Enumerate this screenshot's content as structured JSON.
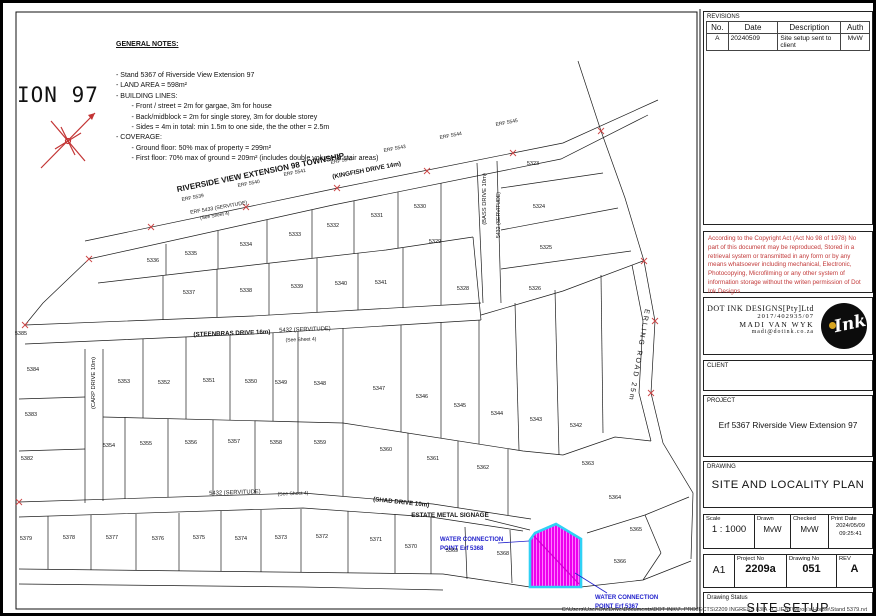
{
  "sheet": {
    "corner_text": "ION 97",
    "footer_path": "C:\\Users\\User\\OneDrive\\Documents\\DOT INK\\7. PROJECTS\\2209 INGRESS 83IA - CLIENT\\Miron's House\\Stand 5379.rvt"
  },
  "notes": {
    "title": "GENERAL NOTES:",
    "lines": [
      "- Stand 5367 of Riverside View Extension 97",
      "- LAND AREA = 598m²",
      "- BUILDING LINES:",
      "        - Front / street = 2m for gargae, 3m for house",
      "        - Back/midblock = 2m for single storey, 3m for double storey",
      "        - Sides = 4m in total: min 1.5m to one side, the the other = 2.5m",
      "- COVERAGE:",
      "        - Ground floor: 50% max of property = 299m²",
      "        - First floor: 70% max of ground = 209m² (includes double volume & stair areas)"
    ]
  },
  "map": {
    "highlight_erf": "5367",
    "highlight_fill": "#EE00EE",
    "highlight_border": "#2FD1F5",
    "labels": [
      {
        "t": "RIVERSIDE VIEW EXTENSION 98 TOWNSHIP",
        "x": 258,
        "y": 172,
        "r": -11.5,
        "s": 8,
        "b": 1,
        "n": "township-label"
      },
      {
        "t": "(KINGFISH DRIVE 14m)",
        "x": 364,
        "y": 169,
        "r": -11,
        "s": 6.3,
        "b": 1,
        "n": "road-label-kingfish"
      },
      {
        "t": "ERF 5433 (SERVITUDE)",
        "x": 216,
        "y": 206,
        "r": -10,
        "s": 5.2,
        "n": "servitude-label"
      },
      {
        "t": "(See Sheet 4)",
        "x": 212,
        "y": 214,
        "r": -10,
        "s": 4.8,
        "n": "see-sheet-label"
      },
      {
        "t": "ERF 5539",
        "x": 190,
        "y": 196,
        "r": -11,
        "s": 5,
        "n": "erf-label"
      },
      {
        "t": "ERF 5540",
        "x": 246,
        "y": 182,
        "r": -11,
        "s": 5,
        "n": "erf-label"
      },
      {
        "t": "ERF 5541",
        "x": 292,
        "y": 171,
        "r": -11,
        "s": 5,
        "n": "erf-label"
      },
      {
        "t": "ERF 5542",
        "x": 339,
        "y": 159,
        "r": -11,
        "s": 5,
        "n": "erf-label"
      },
      {
        "t": "ERF 5543",
        "x": 392,
        "y": 147,
        "r": -11,
        "s": 5,
        "n": "erf-label"
      },
      {
        "t": "ERF 5544",
        "x": 448,
        "y": 134,
        "r": -11,
        "s": 5,
        "n": "erf-label"
      },
      {
        "t": "ERF 5545",
        "x": 504,
        "y": 121,
        "r": -11,
        "s": 5,
        "n": "erf-label"
      },
      {
        "t": "(STEENBRAS DRIVE 16m)",
        "x": 229,
        "y": 332,
        "r": -2,
        "s": 6.2,
        "b": 1,
        "n": "road-label-steenbras"
      },
      {
        "t": "5432 (SERVITUDE)",
        "x": 302,
        "y": 328,
        "r": -2,
        "s": 5.8,
        "n": "servitude-label"
      },
      {
        "t": "(See Sheet 4)",
        "x": 298,
        "y": 338,
        "r": -2,
        "s": 5,
        "n": "see-sheet-label"
      },
      {
        "t": "(BASS DRIVE 10m)",
        "x": 483,
        "y": 196,
        "r": -90,
        "s": 5.8,
        "n": "road-label-bass"
      },
      {
        "t": "5432 (SERVITUDE)",
        "x": 497,
        "y": 212,
        "r": -90,
        "s": 5.2,
        "n": "servitude-label"
      },
      {
        "t": "ERLING ROAD 25m",
        "x": 634,
        "y": 352,
        "r": 100,
        "s": 7,
        "sp": 2,
        "n": "road-label-erling"
      },
      {
        "t": "(CARP DRIVE 10m)",
        "x": 92,
        "y": 380,
        "r": -90,
        "s": 5.8,
        "n": "road-label-carp"
      },
      {
        "t": "5432 (SERVITUDE)",
        "x": 232,
        "y": 491,
        "r": -2,
        "s": 5.8,
        "n": "servitude-label"
      },
      {
        "t": "(See Sheet 4)",
        "x": 290,
        "y": 492,
        "r": -2,
        "s": 5,
        "n": "see-sheet-label"
      },
      {
        "t": "(SHAD DRIVE 10m)",
        "x": 398,
        "y": 501,
        "r": 6,
        "s": 6.2,
        "b": 1,
        "n": "road-label-shad"
      },
      {
        "t": "ESTATE METAL SIGNAGE",
        "x": 447,
        "y": 514,
        "r": 0,
        "s": 6.3,
        "b": 1,
        "n": "signage-label"
      },
      {
        "t": "WATER CONNECTION",
        "x": 437,
        "y": 538,
        "r": 0,
        "s": 6,
        "b": 1,
        "c": "#2222CC",
        "a": "start",
        "n": "water-connection-label-5368"
      },
      {
        "t": "POINT Erf 5368",
        "x": 437,
        "y": 547,
        "r": 0,
        "s": 6,
        "b": 1,
        "c": "#2222CC",
        "a": "start",
        "n": "water-connection-label-5368"
      },
      {
        "t": "WATER CONNECTION",
        "x": 592,
        "y": 596,
        "r": 0,
        "s": 6,
        "b": 1,
        "c": "#2222CC",
        "a": "start",
        "n": "water-connection-label-5367"
      },
      {
        "t": "POINT Erf 5367",
        "x": 592,
        "y": 605,
        "r": 0,
        "s": 6,
        "b": 1,
        "c": "#2222CC",
        "a": "start",
        "n": "water-connection-label-5367"
      }
    ],
    "parcels": [
      {
        "id": "5336",
        "x": 150,
        "y": 259
      },
      {
        "id": "5335",
        "x": 188,
        "y": 252
      },
      {
        "id": "5334",
        "x": 243,
        "y": 243
      },
      {
        "id": "5333",
        "x": 292,
        "y": 233
      },
      {
        "id": "5332",
        "x": 330,
        "y": 224
      },
      {
        "id": "5331",
        "x": 374,
        "y": 214
      },
      {
        "id": "5330",
        "x": 417,
        "y": 205
      },
      {
        "id": "5337",
        "x": 186,
        "y": 291
      },
      {
        "id": "5338",
        "x": 243,
        "y": 289
      },
      {
        "id": "5339",
        "x": 294,
        "y": 285
      },
      {
        "id": "5340",
        "x": 338,
        "y": 282
      },
      {
        "id": "5341",
        "x": 378,
        "y": 281
      },
      {
        "id": "5329",
        "x": 432,
        "y": 240
      },
      {
        "id": "5328",
        "x": 460,
        "y": 287
      },
      {
        "id": "5323",
        "x": 530,
        "y": 162
      },
      {
        "id": "5324",
        "x": 536,
        "y": 205
      },
      {
        "id": "5325",
        "x": 543,
        "y": 246
      },
      {
        "id": "5326",
        "x": 532,
        "y": 287
      },
      {
        "id": "5385",
        "x": 18,
        "y": 332
      },
      {
        "id": "5384",
        "x": 30,
        "y": 368
      },
      {
        "id": "5383",
        "x": 28,
        "y": 413
      },
      {
        "id": "5382",
        "x": 24,
        "y": 457
      },
      {
        "id": "5353",
        "x": 121,
        "y": 380
      },
      {
        "id": "5352",
        "x": 161,
        "y": 381
      },
      {
        "id": "5351",
        "x": 206,
        "y": 379
      },
      {
        "id": "5350",
        "x": 248,
        "y": 380
      },
      {
        "id": "5349",
        "x": 278,
        "y": 381
      },
      {
        "id": "5348",
        "x": 317,
        "y": 382
      },
      {
        "id": "5347",
        "x": 376,
        "y": 387
      },
      {
        "id": "5346",
        "x": 419,
        "y": 395
      },
      {
        "id": "5345",
        "x": 457,
        "y": 404
      },
      {
        "id": "5344",
        "x": 494,
        "y": 412
      },
      {
        "id": "5343",
        "x": 533,
        "y": 418
      },
      {
        "id": "5342",
        "x": 573,
        "y": 424
      },
      {
        "id": "5354",
        "x": 106,
        "y": 444
      },
      {
        "id": "5355",
        "x": 143,
        "y": 442
      },
      {
        "id": "5356",
        "x": 188,
        "y": 441
      },
      {
        "id": "5357",
        "x": 231,
        "y": 440
      },
      {
        "id": "5358",
        "x": 273,
        "y": 441
      },
      {
        "id": "5359",
        "x": 317,
        "y": 441
      },
      {
        "id": "5360",
        "x": 383,
        "y": 448
      },
      {
        "id": "5361",
        "x": 430,
        "y": 457
      },
      {
        "id": "5362",
        "x": 480,
        "y": 466
      },
      {
        "id": "5363",
        "x": 585,
        "y": 462
      },
      {
        "id": "5379",
        "x": 23,
        "y": 537
      },
      {
        "id": "5378",
        "x": 66,
        "y": 536
      },
      {
        "id": "5377",
        "x": 109,
        "y": 536
      },
      {
        "id": "5376",
        "x": 155,
        "y": 537
      },
      {
        "id": "5375",
        "x": 196,
        "y": 536
      },
      {
        "id": "5374",
        "x": 238,
        "y": 537
      },
      {
        "id": "5373",
        "x": 278,
        "y": 536
      },
      {
        "id": "5372",
        "x": 319,
        "y": 535
      },
      {
        "id": "5371",
        "x": 373,
        "y": 538
      },
      {
        "id": "5370",
        "x": 408,
        "y": 545
      },
      {
        "id": "5369",
        "x": 449,
        "y": 549
      },
      {
        "id": "5368",
        "x": 500,
        "y": 552
      },
      {
        "id": "5366",
        "x": 617,
        "y": 560
      },
      {
        "id": "5365",
        "x": 633,
        "y": 528
      },
      {
        "id": "5364",
        "x": 612,
        "y": 496
      }
    ]
  },
  "titleblock": {
    "revisions": {
      "label": "REVISIONS",
      "columns": [
        "No.",
        "Date",
        "Description",
        "Auth"
      ],
      "rows": [
        {
          "no": "A",
          "date": "20240509",
          "description": "Site setup sent to client",
          "auth": "MvW"
        }
      ]
    },
    "copyright": "According to the Copyright Act (Act No 98 of 1978) No part of this document may be reproduced, Stored in a retrieval system or transmitted in any form or by any means whatsoever including mechanical, Electronic, Photocopying, Microfilming or any other system of information storage without the writen permission of Dot Ink Designs",
    "company": {
      "name": "DOT INK DESIGNS[Pty]Ltd",
      "reg_no": "2017/402935/07",
      "contact": "MADI VAN WYK",
      "email": "madi@dotink.co.za",
      "logo_text": "Ink"
    },
    "client_label": "CLIENT",
    "project": {
      "label": "PROJECT",
      "value": "Erf 5367 Riverside View Extension 97"
    },
    "drawing": {
      "label": "DRAWING",
      "value": "SITE AND LOCALITY PLAN"
    },
    "scale": {
      "label": "Scale",
      "value": "1 : 1000"
    },
    "drawn": {
      "label": "Drawn",
      "value": "MvW"
    },
    "checked": {
      "label": "Checked",
      "value": "MvW"
    },
    "print_date": {
      "label": "Print Date",
      "value": "2024/05/09",
      "time": "09:25:41"
    },
    "sheet_size": "A1",
    "project_no": {
      "label": "Project No",
      "value": "2209a"
    },
    "drawing_no": {
      "label": "Drawing No",
      "value": "051"
    },
    "rev": {
      "label": "REV",
      "value": "A"
    },
    "status": {
      "label": "Drawing Status",
      "value": "SITE SETUP"
    }
  }
}
